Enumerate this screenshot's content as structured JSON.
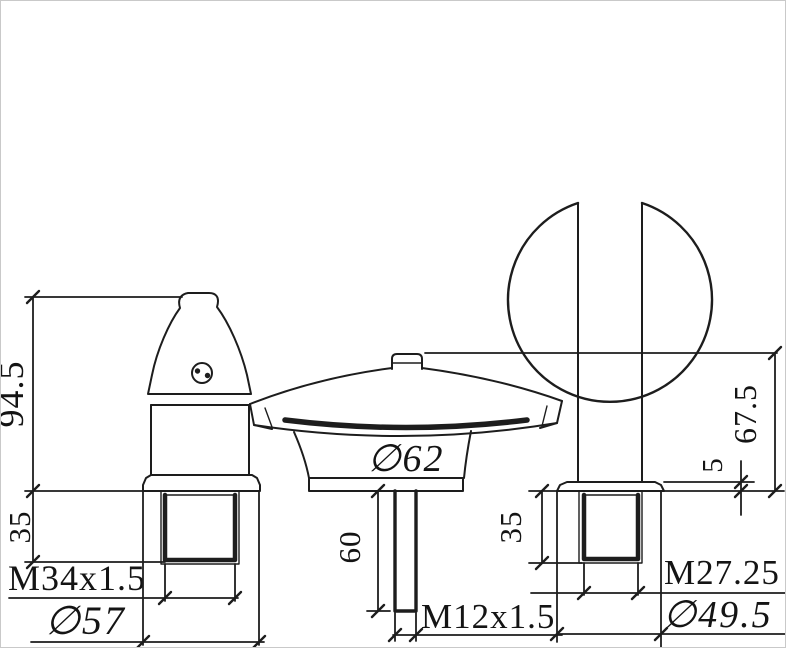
{
  "drawing": {
    "ink_color": "#1d1d1d",
    "background_color": "#ffffff",
    "left_handle": {
      "height_mm": "94.5",
      "thread_length_mm": "35",
      "thread_spec": "M34x1.5",
      "base_diameter": "∅57"
    },
    "spout": {
      "body_diameter": "∅62",
      "shank_length_mm": "60",
      "shank_thread_spec": "M12x1.5"
    },
    "right_handle": {
      "height_mm": "67.5",
      "flange_height_mm": "5",
      "thread_length_mm": "35",
      "thread_spec": "M27.25",
      "base_diameter": "∅49.5"
    }
  }
}
